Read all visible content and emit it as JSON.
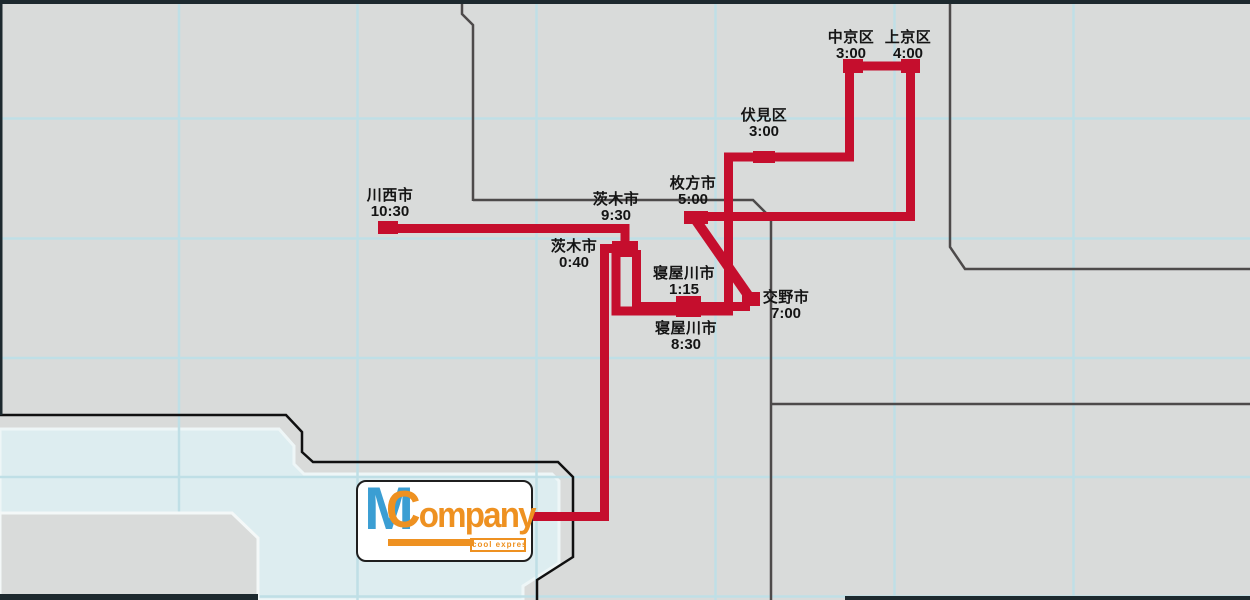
{
  "map": {
    "stops": [
      {
        "id": "ibaraki-first",
        "name": "茨木市",
        "time": "0:40"
      },
      {
        "id": "neyagawa-first",
        "name": "寝屋川市",
        "time": "1:15"
      },
      {
        "id": "fushimi",
        "name": "伏見区",
        "time": "3:00"
      },
      {
        "id": "nakagyo",
        "name": "中京区",
        "time": "3:00"
      },
      {
        "id": "kamigyo",
        "name": "上京区",
        "time": "4:00"
      },
      {
        "id": "hirakata",
        "name": "枚方市",
        "time": "5:00"
      },
      {
        "id": "katano",
        "name": "交野市",
        "time": "7:00"
      },
      {
        "id": "neyagawa-second",
        "name": "寝屋川市",
        "time": "8:30"
      },
      {
        "id": "ibaraki-second",
        "name": "茨木市",
        "time": "9:30"
      },
      {
        "id": "kawanishi",
        "name": "川西市",
        "time": "10:30"
      }
    ],
    "logo": {
      "initial": "M",
      "word": "Company",
      "tagline": "cool express"
    },
    "colors": {
      "route_red": "#c50e2d",
      "land_gray": "#d9dbda",
      "water_blue": "#ddedf0",
      "grid_blue": "#bfdfe6",
      "border_gray": "#4d4a4a",
      "coast_black": "#101010",
      "frame_dark": "#1d292e",
      "logo_blue": "#3b9ed3",
      "logo_orange": "#ee9121",
      "label_text": "#141414"
    }
  }
}
